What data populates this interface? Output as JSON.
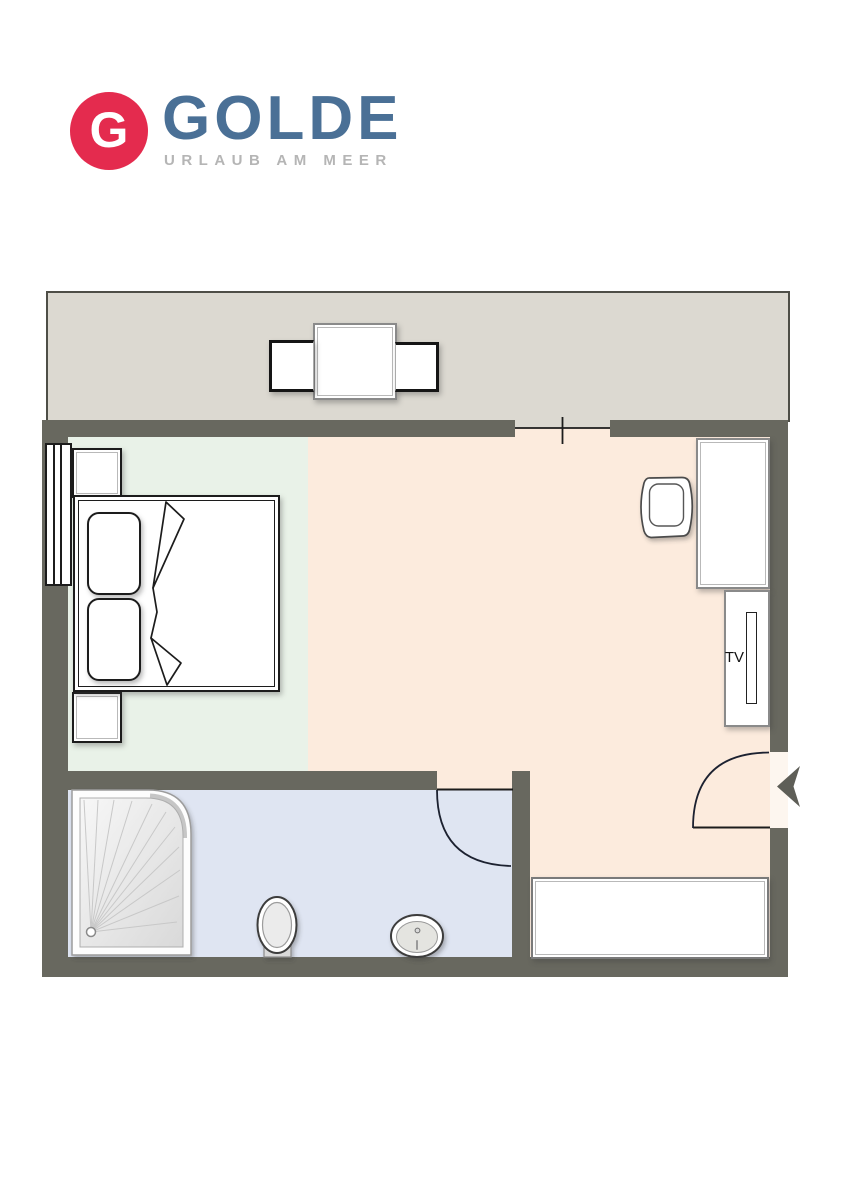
{
  "logo": {
    "monogram": "G",
    "brand": "GOLDE",
    "tagline": "URLAUB AM MEER"
  },
  "labels": {
    "tv": "TV"
  },
  "colors": {
    "logo_red": "#e42b4e",
    "brand_blue": "#4a7096",
    "tagline_gray": "#b5b5b5",
    "wall": "#68685f",
    "wall_edge": "#4e4e47",
    "balcony": "#dcd9d1",
    "bedroom": "#e9f2e8",
    "living": "#fcebdd",
    "bath": "#dfe5f2",
    "outline": "#1c1c1c",
    "furniture_border": "#8a8a8a",
    "door_arc": "#1c2130",
    "arrow": "#5e5e57"
  }
}
